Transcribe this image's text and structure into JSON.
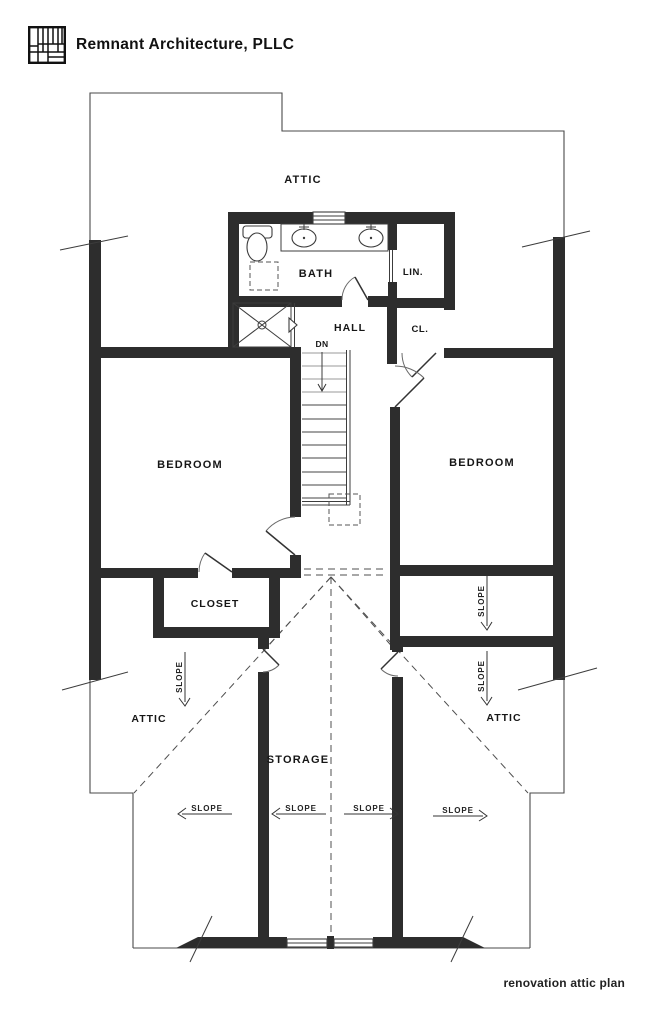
{
  "header": {
    "firm_name": "Remnant Architecture, PLLC",
    "logo": "grid-plan-logo"
  },
  "footer": {
    "drawing_title": "renovation attic plan"
  },
  "plan": {
    "rooms": {
      "attic_top": "ATTIC",
      "bath": "BATH",
      "linen": "LIN.",
      "hall": "HALL",
      "closet_small": "CL.",
      "bedroom_left": "BEDROOM",
      "bedroom_right": "BEDROOM",
      "closet": "CLOSET",
      "attic_left": "ATTIC",
      "attic_right": "ATTIC",
      "storage": "STORAGE"
    },
    "annotations": {
      "stair_direction": "DN",
      "slope": "SLOPE"
    },
    "symbols": [
      "toilet-symbol",
      "sink-symbol",
      "shower-symbol",
      "stairs-symbol",
      "window-symbol",
      "door-swing-symbol"
    ],
    "colors": {
      "wall": "#2d2d2d",
      "line": "#3c3c3c",
      "dashed_line": "#4f4f4f",
      "text": "#161616",
      "background": "#ffffff"
    }
  }
}
